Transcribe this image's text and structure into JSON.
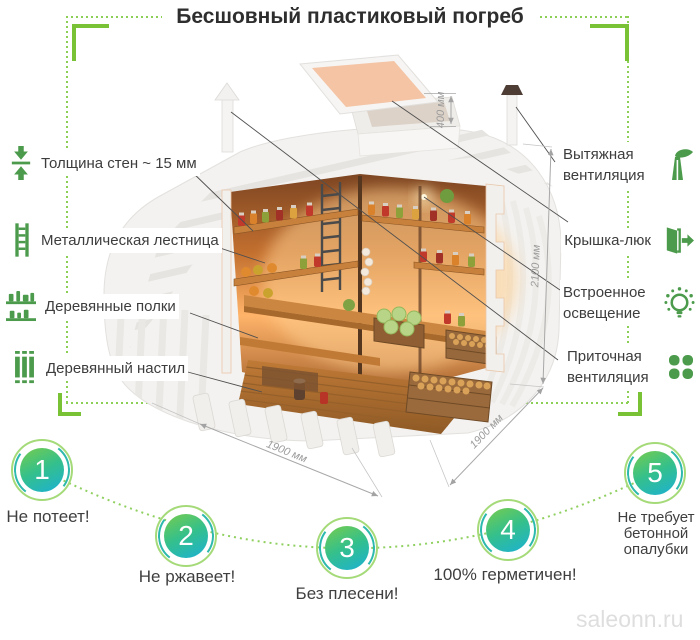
{
  "title": "Бесшовный пластиковый погреб",
  "colors": {
    "accent_green": "#79c235",
    "dotted_green": "#8bd054",
    "icon_green": "#4c9b4c",
    "badge_gradient_start": "#6cca57",
    "badge_gradient_end": "#1fb3c9",
    "badge_ring": "#a5da79",
    "dimension_gray": "#9b9b9b"
  },
  "left_features": [
    {
      "label": "Толщина стен ~ 15 мм",
      "icon": "wall-thickness-icon"
    },
    {
      "label": "Металлическая лестница",
      "icon": "ladder-icon"
    },
    {
      "label": "Деревянные полки",
      "icon": "shelves-icon"
    },
    {
      "label": "Деревянный настил",
      "icon": "planks-icon"
    }
  ],
  "right_features": [
    {
      "label": "Вытяжная вентиляция",
      "icon": "exhaust-vent-icon"
    },
    {
      "label": "Крышка-люк",
      "icon": "hatch-door-icon"
    },
    {
      "label": "Встроенное освещение",
      "icon": "light-bulb-icon"
    },
    {
      "label": "Приточная вентиляция",
      "icon": "fan-icon"
    }
  ],
  "dimensions": {
    "hatch_height": "400 мм",
    "body_height": "2100 мм",
    "width_front": "1900 мм",
    "depth_side": "1900 мм"
  },
  "benefits": [
    {
      "number": "1",
      "label": "Не потеет!"
    },
    {
      "number": "2",
      "label": "Не ржавеет!"
    },
    {
      "number": "3",
      "label": "Без плесени!"
    },
    {
      "number": "4",
      "label": "100% герметичен!"
    },
    {
      "number": "5",
      "label": "Не требует бетонной опалубки"
    }
  ],
  "watermark": "saleonn.ru"
}
